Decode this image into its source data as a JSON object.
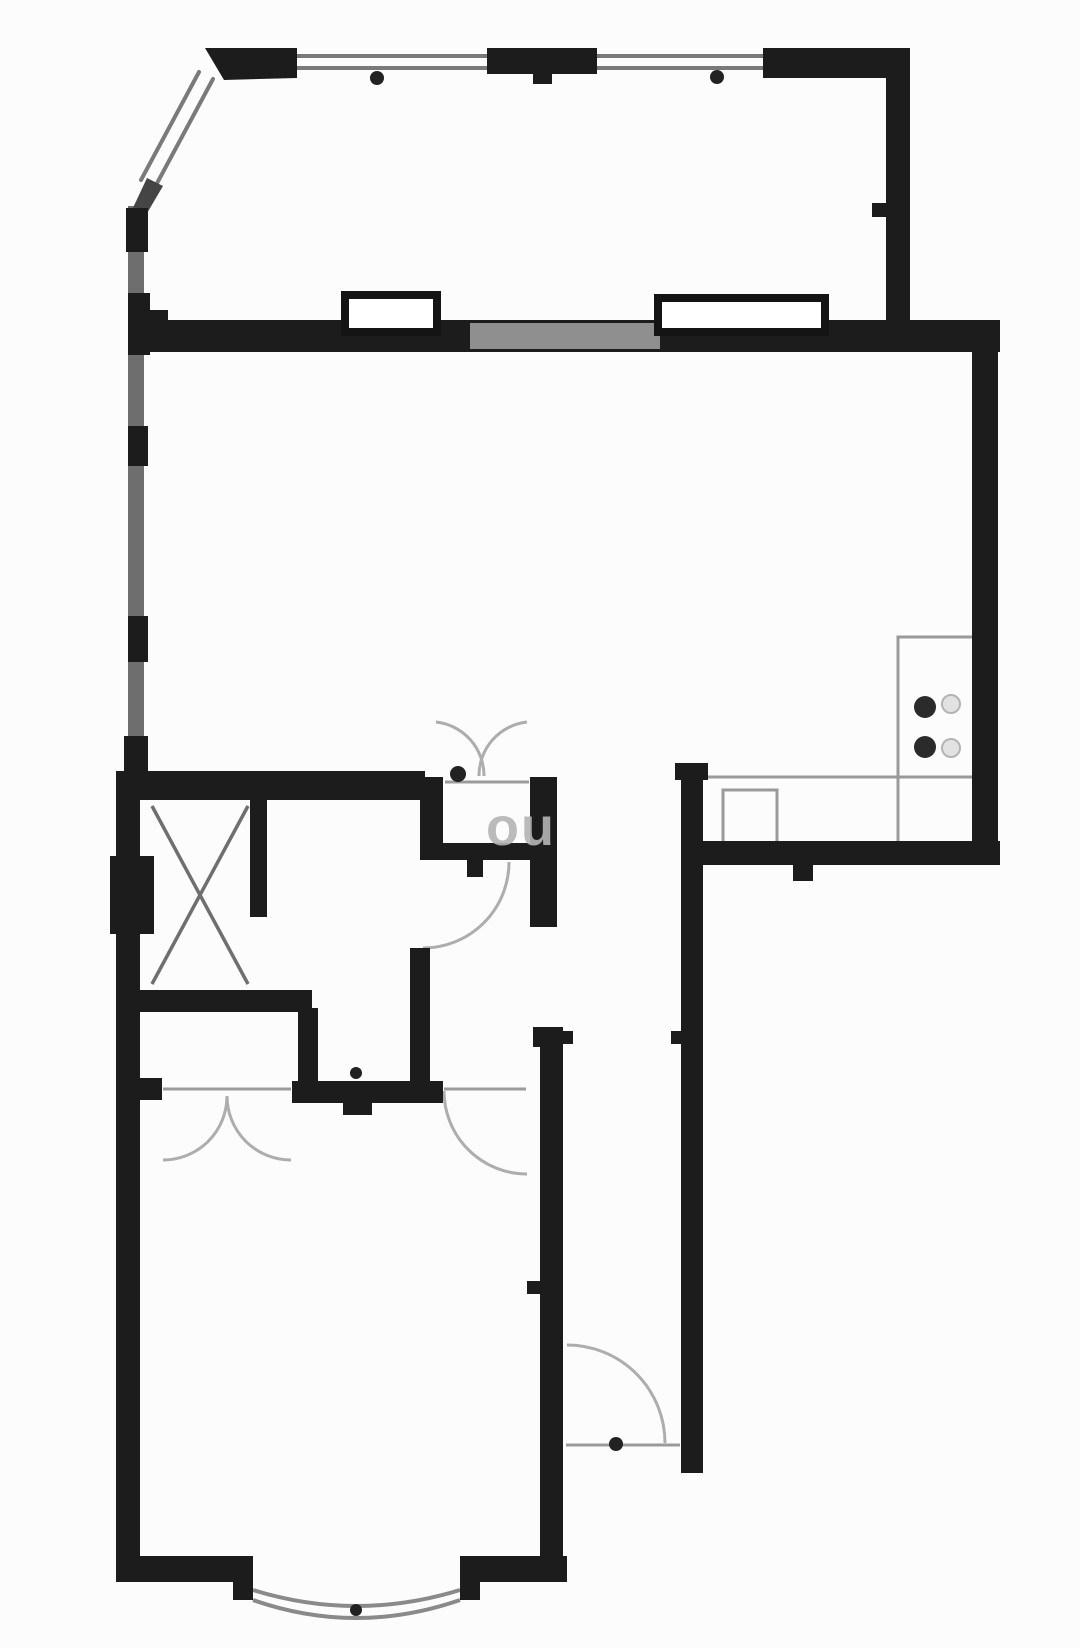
{
  "watermark": {
    "text": "ou"
  },
  "plan": {
    "canvas": {
      "w": 1080,
      "h": 1648,
      "bg": "#fcfcfc"
    },
    "colors": {
      "wall": "#1c1c1c",
      "wall_gray": "#6e6e6e",
      "wall_tint": "#8f8f8f",
      "window": "#7a7a7a",
      "threshold": "#9b9b9b",
      "arc": "#adadad",
      "bay": "#8a8a8a",
      "fixture": "#9a9a9a",
      "burner_dark": "#2b2b2b",
      "burner_faint_fill": "#e2e2e2",
      "burner_faint_stroke": "#b4b4b4",
      "dot": "#222222",
      "radiator_stroke": "#141414",
      "radiator_fill": "#ffffff"
    },
    "windows": [
      [
        297,
        56,
        487,
        56
      ],
      [
        297,
        68,
        487,
        68
      ],
      [
        597,
        56,
        763,
        56
      ],
      [
        597,
        68,
        763,
        68
      ],
      [
        199,
        72,
        141,
        180
      ],
      [
        213,
        79,
        155,
        187
      ]
    ],
    "thresholds": [
      [
        445,
        782,
        529,
        782
      ],
      [
        163,
        1089,
        291,
        1089
      ],
      [
        444,
        1089,
        526,
        1089
      ],
      [
        566,
        1445,
        680,
        1445
      ]
    ],
    "x_mark": [
      [
        152,
        806,
        248,
        984
      ],
      [
        248,
        806,
        152,
        984
      ]
    ],
    "door_arcs": [
      "M436,722 A54,54 0 0 1 484,776",
      "M527,722 A54,54 0 0 0 479,776",
      "M227,1096 A64,64 0 0 1 163,1160",
      "M227,1096 A64,64 0 0 0 291,1160",
      "M444,1091 A83,83 0 0 0 527,1174",
      "M423,948 A86,86 0 0 0 509,862",
      "M567,1345 A98,98 0 0 1 665,1443"
    ],
    "bay_arcs": [
      "M253,1600 Q356,1636 460,1600",
      "M253,1590 Q356,1622 460,1590"
    ],
    "fixtures": [
      [
        898,
        637,
        77,
        208
      ],
      [
        683,
        777,
        292,
        66
      ],
      [
        723,
        790,
        54,
        53
      ]
    ],
    "wall_base": [
      [
        128,
        206,
        16,
        572
      ]
    ],
    "wall_polys": [
      {
        "pts": "205,48 297,48 297,78 224,80",
        "fill": "#1c1c1c"
      },
      {
        "pts": "147,178 163,186 143,220 131,212",
        "fill": "#454545"
      }
    ],
    "walls": [
      [
        487,
        48,
        110,
        26
      ],
      [
        763,
        48,
        147,
        30
      ],
      [
        886,
        48,
        24,
        292
      ],
      [
        130,
        320,
        870,
        32
      ],
      [
        972,
        337,
        26,
        528
      ],
      [
        681,
        841,
        319,
        24
      ],
      [
        675,
        763,
        33,
        17
      ],
      [
        681,
        763,
        22,
        710
      ],
      [
        116,
        771,
        309,
        29
      ],
      [
        420,
        777,
        23,
        83
      ],
      [
        530,
        777,
        27,
        150
      ],
      [
        420,
        843,
        137,
        17
      ],
      [
        250,
        798,
        17,
        119
      ],
      [
        116,
        990,
        196,
        22
      ],
      [
        298,
        1008,
        20,
        82
      ],
      [
        410,
        948,
        20,
        142
      ],
      [
        292,
        1081,
        151,
        22
      ],
      [
        116,
        1078,
        46,
        22
      ],
      [
        533,
        1027,
        30,
        20
      ],
      [
        540,
        1045,
        23,
        537
      ],
      [
        116,
        771,
        24,
        811
      ],
      [
        110,
        856,
        44,
        78
      ],
      [
        116,
        1556,
        137,
        26
      ],
      [
        460,
        1556,
        107,
        26
      ],
      [
        233,
        1570,
        20,
        30
      ],
      [
        460,
        1570,
        20,
        30
      ],
      [
        126,
        208,
        22,
        44
      ],
      [
        128,
        293,
        22,
        62
      ],
      [
        128,
        426,
        20,
        40
      ],
      [
        128,
        616,
        20,
        46
      ],
      [
        124,
        736,
        24,
        40
      ],
      [
        148,
        310,
        20,
        42
      ],
      [
        533,
        68,
        19,
        16
      ],
      [
        872,
        203,
        14,
        14
      ],
      [
        563,
        1031,
        10,
        13
      ],
      [
        671,
        1031,
        10,
        13
      ],
      [
        527,
        1281,
        14,
        13
      ],
      [
        467,
        860,
        16,
        17
      ],
      [
        343,
        1103,
        29,
        12
      ],
      [
        793,
        865,
        20,
        16
      ]
    ],
    "wall_tints": [
      [
        470,
        323,
        190,
        26
      ]
    ],
    "radiators": [
      [
        345,
        295,
        92,
        37
      ],
      [
        658,
        298,
        167,
        34
      ]
    ],
    "burners_dark": [
      [
        925,
        707,
        11
      ],
      [
        925,
        747,
        11
      ]
    ],
    "burners_faint": [
      [
        951,
        704,
        9
      ],
      [
        951,
        748,
        9
      ]
    ],
    "dots": [
      [
        377,
        78,
        7
      ],
      [
        717,
        77,
        7
      ],
      [
        458,
        774,
        8
      ],
      [
        356,
        1073,
        6
      ],
      [
        616,
        1444,
        7
      ],
      [
        356,
        1610,
        6
      ]
    ]
  }
}
